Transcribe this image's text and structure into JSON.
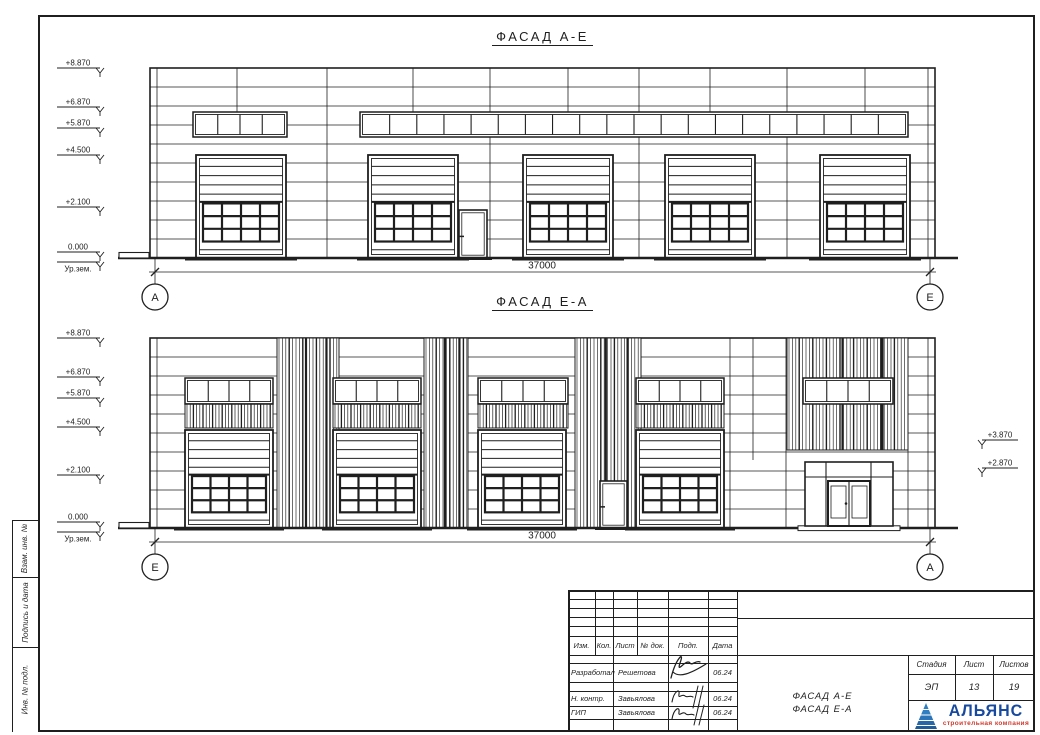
{
  "colors": {
    "line": "#1f1f1f",
    "logo_blue": "#2a6db5",
    "logo_text": "#17499e",
    "logo_sub": "#d13a2e"
  },
  "facade_ae": {
    "title": "ФАСАД А-Е",
    "dimension": "37000",
    "bubble_left": "А",
    "bubble_right": "Е",
    "wall": {
      "x": 150,
      "y": 68,
      "w": 785,
      "h": 190
    },
    "hline_step": 19,
    "top_verticals": [
      237,
      413,
      568,
      710,
      865
    ],
    "top_vertical_end": 112,
    "full_verticals": [
      157,
      928,
      327,
      490,
      639,
      787
    ],
    "louver_cols": [],
    "louver_tops": [],
    "louver_bands": [],
    "windows": [
      {
        "x": 193,
        "y": 112,
        "w": 94,
        "h": 25,
        "panes": 4
      },
      {
        "x": 360,
        "y": 112,
        "w": 548,
        "h": 25,
        "panes": 20
      }
    ],
    "garage_doors": [
      {
        "x": 196
      },
      {
        "x": 368
      },
      {
        "x": 523
      },
      {
        "x": 665
      },
      {
        "x": 820
      }
    ],
    "door_w": 90,
    "door_y": 155,
    "door_h": 103,
    "ped_doors": [
      {
        "x": 459,
        "y": 210,
        "w": 28,
        "h": 48
      }
    ],
    "ground_y": 258,
    "dim_y": 272,
    "dim_x0": 155,
    "dim_x1": 930,
    "bubble_cy": 297,
    "elevations": [
      {
        "label": "+8.870",
        "y": 68
      },
      {
        "label": "+6.870",
        "y": 107
      },
      {
        "label": "+5.870",
        "y": 128
      },
      {
        "label": "+4.500",
        "y": 155
      },
      {
        "label": "+2.100",
        "y": 207
      },
      {
        "label": "0.000",
        "y": 252
      },
      {
        "label": "Ур.зем.",
        "y": 262,
        "below": true
      }
    ],
    "right_marks": []
  },
  "facade_ea": {
    "title": "ФАСАД Е-А",
    "dimension": "37000",
    "bubble_left": "Е",
    "bubble_right": "А",
    "wall": {
      "x": 150,
      "y": 338,
      "w": 785,
      "h": 190
    },
    "hline_step": 19,
    "top_verticals": [
      753
    ],
    "top_vertical_end": 460,
    "full_verticals": [
      157,
      928,
      730,
      786,
      908
    ],
    "louver_cols": [
      {
        "x": 277,
        "w": 62
      },
      {
        "x": 424,
        "w": 44
      },
      {
        "x": 575,
        "w": 66
      }
    ],
    "louver_tops": [
      {
        "x": 787,
        "w": 121,
        "y2": 450
      }
    ],
    "windows": [
      {
        "x": 185,
        "y": 378,
        "w": 88,
        "h": 26,
        "panes": 4
      },
      {
        "x": 333,
        "y": 378,
        "w": 88,
        "h": 26,
        "panes": 4
      },
      {
        "x": 478,
        "y": 378,
        "w": 90,
        "h": 26,
        "panes": 4
      },
      {
        "x": 636,
        "y": 378,
        "w": 88,
        "h": 26,
        "panes": 4
      },
      {
        "x": 803,
        "y": 378,
        "w": 90,
        "h": 26,
        "panes": 4
      }
    ],
    "louver_bands": [
      {
        "x": 185,
        "y": 404,
        "w": 88,
        "h": 24
      },
      {
        "x": 333,
        "y": 404,
        "w": 88,
        "h": 24
      },
      {
        "x": 478,
        "y": 404,
        "w": 90,
        "h": 24
      },
      {
        "x": 636,
        "y": 404,
        "w": 88,
        "h": 24
      }
    ],
    "garage_doors": [
      {
        "x": 185
      },
      {
        "x": 333
      },
      {
        "x": 478
      },
      {
        "x": 636
      }
    ],
    "door_w": 88,
    "door_y": 430,
    "door_h": 98,
    "ped_doors": [
      {
        "x": 600,
        "y": 481,
        "w": 27,
        "h": 47
      }
    ],
    "storefront": {
      "x": 805,
      "y": 462,
      "w": 88,
      "h": 64
    },
    "ground_y": 528,
    "dim_y": 542,
    "dim_x0": 155,
    "dim_x1": 930,
    "bubble_cy": 567,
    "elevations": [
      {
        "label": "+8.870",
        "y": 338
      },
      {
        "label": "+6.870",
        "y": 377
      },
      {
        "label": "+5.870",
        "y": 398
      },
      {
        "label": "+4.500",
        "y": 427
      },
      {
        "label": "+2.100",
        "y": 475
      },
      {
        "label": "0.000",
        "y": 522
      },
      {
        "label": "Ур.зем.",
        "y": 532,
        "below": true
      }
    ],
    "right_marks": [
      {
        "label": "+3.870",
        "y": 440
      },
      {
        "label": "+2.870",
        "y": 468
      }
    ]
  },
  "side_labels": [
    "Взам. инв. №",
    "Подпись и дата",
    "Инв. № подл."
  ],
  "stamp": {
    "rev_headers": [
      "Изм.",
      "Кол.",
      "Лист",
      "№ док.",
      "Подп.",
      "Дата"
    ],
    "sign_rows": [
      {
        "role": "Разработал",
        "name": "Решетова",
        "date": "06.24"
      },
      {
        "role": "Н. контр.",
        "name": "Завьялова",
        "date": "06.24"
      },
      {
        "role": "ГИП",
        "name": "Завьялова",
        "date": "06.24"
      }
    ],
    "doc_title_lines": [
      "ФАСАД А-Е",
      "ФАСАД Е-А"
    ],
    "stage_headers": [
      "Стадия",
      "Лист",
      "Листов"
    ],
    "stage_values": [
      "ЭП",
      "13",
      "19"
    ],
    "logo": {
      "name": "АЛЬЯНС",
      "subtitle": "строительная компания"
    }
  }
}
